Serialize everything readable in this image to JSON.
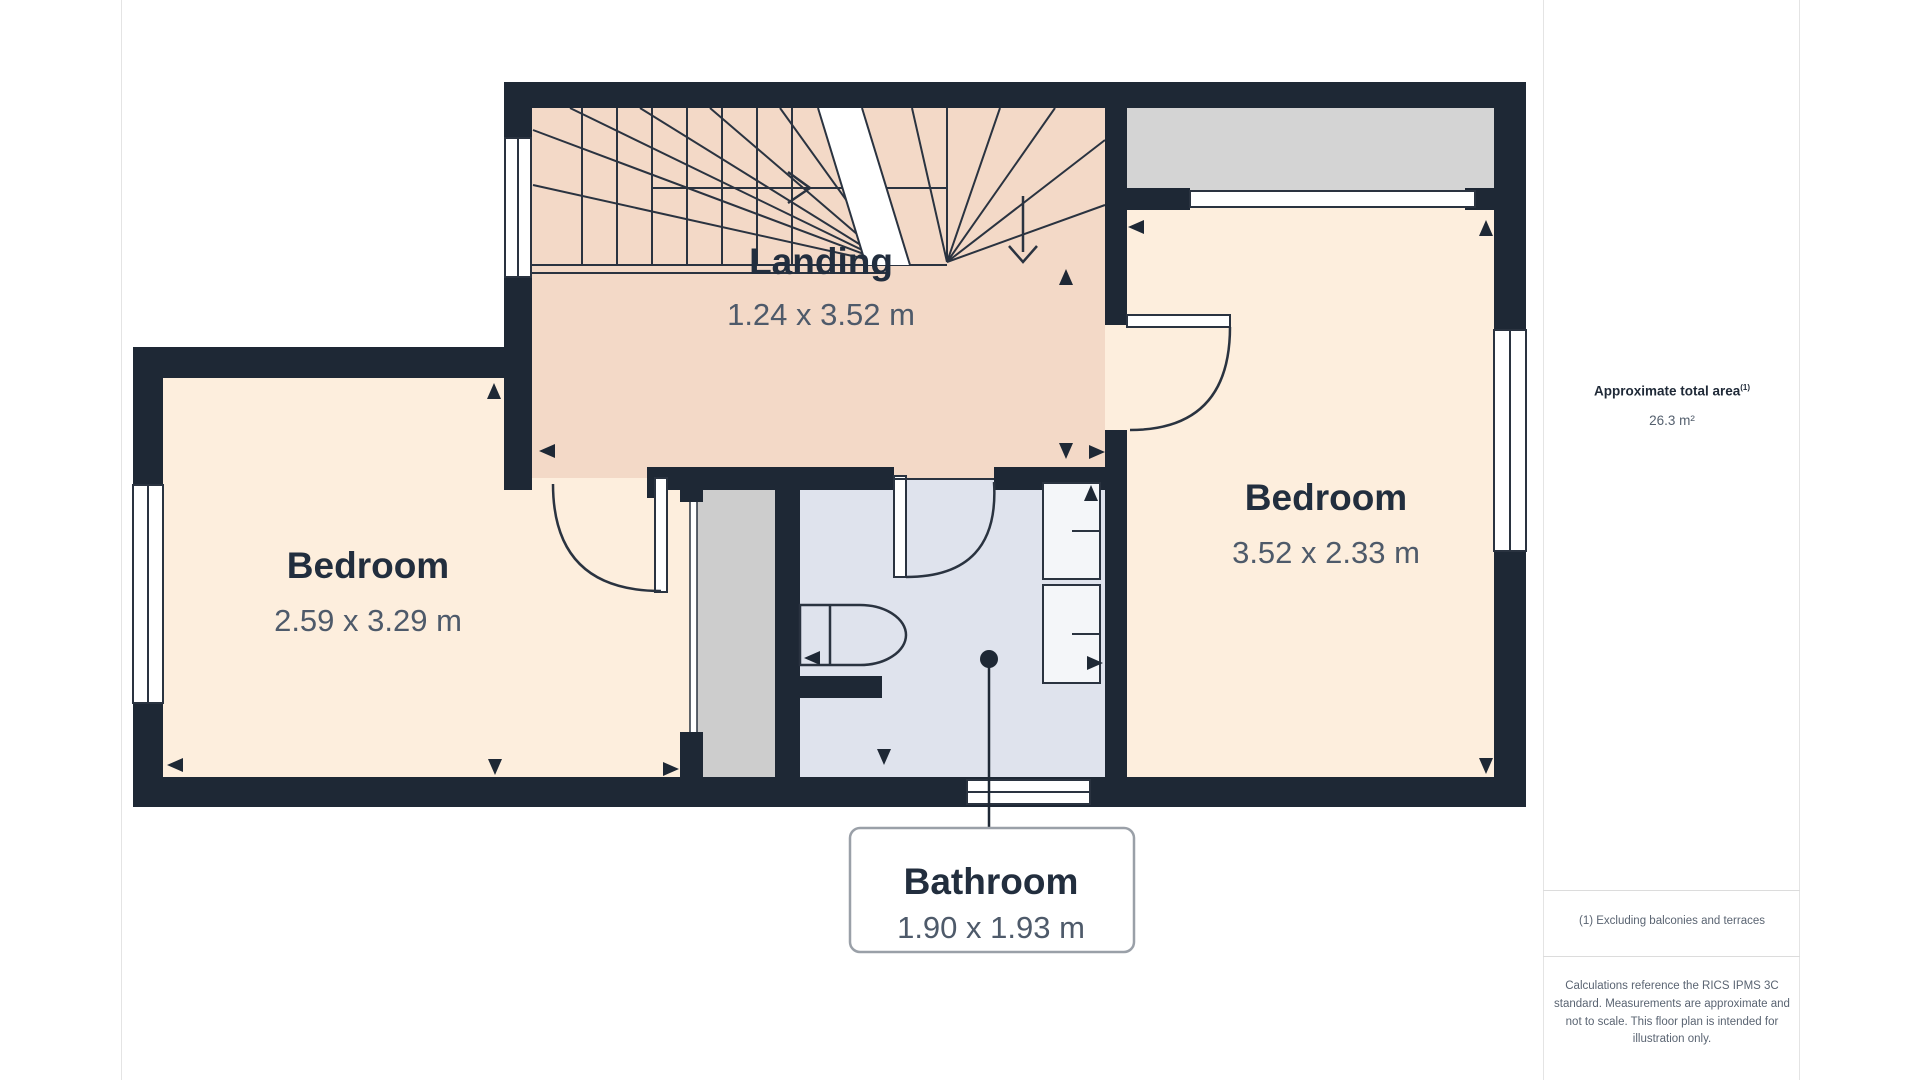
{
  "rooms": {
    "landing": {
      "name": "Landing",
      "dims": "1.24 x 3.52 m"
    },
    "bedroom_left": {
      "name": "Bedroom",
      "dims": "2.59 x 3.29 m"
    },
    "bedroom_right": {
      "name": "Bedroom",
      "dims": "3.52 x 2.33 m"
    },
    "bathroom": {
      "name": "Bathroom",
      "dims": "1.90 x 1.93 m"
    }
  },
  "sidebar": {
    "total_area_label": "Approximate total area",
    "total_area_superscript": "(1)",
    "total_area_value": "26.3 m²",
    "footnote": "(1) Excluding balconies and terraces",
    "disclaimer": "Calculations reference the RICS IPMS 3C standard. Measurements are approximate and not to scale. This floor plan is intended for illustration only."
  },
  "colors": {
    "wall": "#1e2835",
    "landing_floor": "#f3d9c7",
    "bedroom_floor": "#fdeedd",
    "bathroom_floor": "#dfe3ed",
    "closet_gray": "#cdcdcd",
    "eaves_gray": "#d4d4d4",
    "line": "#2a3340",
    "dim_text": "#4e5a6a",
    "name_text": "#222e3e"
  }
}
